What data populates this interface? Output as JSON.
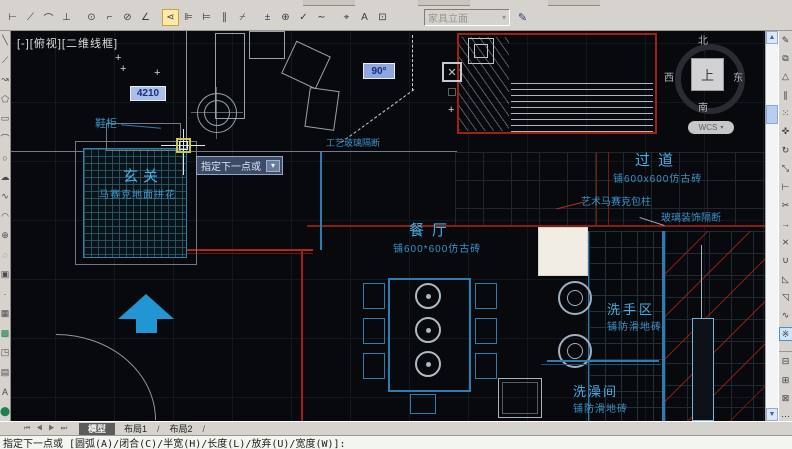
{
  "top_toolbar": {
    "dim_style": {
      "value": "家具立面",
      "caret": "▾"
    },
    "dim_icons": [
      {
        "n": "dim-linear-icon",
        "g": "⊢"
      },
      {
        "n": "dim-aligned-icon",
        "g": "⟋"
      },
      {
        "n": "dim-arc-length-icon",
        "g": "⌒"
      },
      {
        "n": "dim-ordinate-icon",
        "g": "⊥"
      },
      {
        "n": "dim-radius-icon",
        "g": "⊙",
        "sep": true
      },
      {
        "n": "dim-jogged-icon",
        "g": "⌐"
      },
      {
        "n": "dim-diameter-icon",
        "g": "⊘"
      },
      {
        "n": "dim-angular-icon",
        "g": "∠"
      },
      {
        "n": "dim-quick-icon",
        "g": "⋖",
        "hl": true,
        "sep": true
      },
      {
        "n": "dim-baseline-icon",
        "g": "⊫"
      },
      {
        "n": "dim-continue-icon",
        "g": "⊨"
      },
      {
        "n": "dim-space-icon",
        "g": "∥"
      },
      {
        "n": "dim-break-icon",
        "g": "⌿"
      },
      {
        "n": "dim-tolerance-icon",
        "g": "±",
        "sep": true
      },
      {
        "n": "dim-center-mark-icon",
        "g": "⊕"
      },
      {
        "n": "dim-inspect-icon",
        "g": "✓"
      },
      {
        "n": "dim-jogged-linear-icon",
        "g": "∼"
      },
      {
        "n": "dim-edit-icon",
        "g": "⌖",
        "sep": true
      },
      {
        "n": "dim-text-edit-icon",
        "g": "A"
      },
      {
        "n": "dim-update-icon",
        "g": "⊡"
      }
    ],
    "style_manager_icon": "✎"
  },
  "left_toolbar": {
    "icons": [
      {
        "n": "draw-line-icon",
        "g": "╲"
      },
      {
        "n": "draw-xline-icon",
        "g": "⟋"
      },
      {
        "n": "draw-polyline-icon",
        "g": "↝"
      },
      {
        "n": "draw-polygon-icon",
        "g": "⬠"
      },
      {
        "n": "draw-rectangle-icon",
        "g": "▭"
      },
      {
        "n": "draw-arc-icon",
        "g": "⌒"
      },
      {
        "n": "draw-circle-icon",
        "g": "○"
      },
      {
        "n": "draw-revcloud-icon",
        "g": "☁"
      },
      {
        "n": "draw-spline-icon",
        "g": "∿"
      },
      {
        "n": "draw-ellipse-icon",
        "g": "◠"
      },
      {
        "n": "draw-ellipse-arc-icon",
        "g": "⊕"
      },
      {
        "n": "draw-insert-block-icon",
        "g": "◌"
      },
      {
        "n": "draw-make-block-icon",
        "g": "▣"
      },
      {
        "n": "draw-point-icon",
        "g": "·"
      },
      {
        "n": "draw-hatch-icon",
        "g": "▦"
      },
      {
        "n": "draw-gradient-icon",
        "g": "▩",
        "hl": true
      },
      {
        "n": "draw-region-icon",
        "g": "◳"
      },
      {
        "n": "draw-table-icon",
        "g": "▤"
      },
      {
        "n": "draw-mtext-icon",
        "g": "A"
      },
      {
        "n": "draw-scale-ref-icon",
        "g": "⬤",
        "hl": true
      }
    ]
  },
  "right_toolbar": {
    "icons": [
      {
        "n": "modify-erase-icon",
        "g": "✎"
      },
      {
        "n": "modify-copy-icon",
        "g": "⧉"
      },
      {
        "n": "modify-mirror-icon",
        "g": "△"
      },
      {
        "n": "modify-offset-icon",
        "g": "∥"
      },
      {
        "n": "modify-array-icon",
        "g": "⁙"
      },
      {
        "n": "modify-move-icon",
        "g": "✜"
      },
      {
        "n": "modify-rotate-icon",
        "g": "↻"
      },
      {
        "n": "modify-scale-icon",
        "g": "⤡"
      },
      {
        "n": "modify-stretch-icon",
        "g": "⊢"
      },
      {
        "n": "modify-trim-icon",
        "g": "✂"
      },
      {
        "n": "modify-extend-icon",
        "g": "→"
      },
      {
        "n": "modify-break-point-icon",
        "g": "⨯"
      },
      {
        "n": "modify-join-icon",
        "g": "∪"
      },
      {
        "n": "modify-chamfer-icon",
        "g": "◺"
      },
      {
        "n": "modify-fillet-icon",
        "g": "◹"
      },
      {
        "n": "modify-spline-edit-icon",
        "g": "∿"
      },
      {
        "n": "modify-explode-icon",
        "g": "※",
        "hl": true
      },
      {
        "n": "draworder-front-icon",
        "g": "⊟",
        "sep": true
      },
      {
        "n": "draworder-back-icon",
        "g": "⊞"
      },
      {
        "n": "draworder-above-icon",
        "g": "⊠"
      },
      {
        "n": "draworder-more-icon",
        "g": "⋯"
      }
    ]
  },
  "scrollbar": {
    "up": "▲",
    "down": "▼"
  },
  "viewport": {
    "label": "[-][俯视][二维线框]"
  },
  "viewcube": {
    "north": "北",
    "south": "南",
    "east": "东",
    "west": "西",
    "top": "上",
    "wcs": "WCS",
    "caret": "▾"
  },
  "plan": {
    "rooms": [
      {
        "name": "玄关",
        "sub": "马赛克地面拼花"
      },
      {
        "name": "过道",
        "sub": "铺600x600仿古砖"
      },
      {
        "name": "餐厅",
        "sub": "铺600*600仿古砖"
      },
      {
        "name": "洗手区",
        "sub": "铺防滑地砖"
      },
      {
        "name": "洗澡间",
        "sub": "铺防滑地砖"
      }
    ],
    "annotations": [
      {
        "text": "鞋柜"
      },
      {
        "text": "工艺玻璃隔断"
      },
      {
        "text": "艺术马赛克包柱"
      },
      {
        "text": "玻璃装饰隔断"
      }
    ],
    "blip": "+",
    "xmark": "✕"
  },
  "dynamic_input": {
    "length": "4210",
    "angle": "90°",
    "tooltip": "指定下一点或",
    "tooltip_key": "▾"
  },
  "tabs": {
    "nav": "⏮ ◀ ▶ ⏭",
    "model": "模型",
    "layout1": "布局1",
    "layout2": "布局2",
    "slash": "/"
  },
  "command_line": {
    "prompt": "指定下一点或 [圆弧(A)/闭合(C)/半宽(H)/长度(L)/放弃(U)/宽度(W)]:"
  },
  "colors": {
    "accent_cyan": "#45b0e6",
    "wall_red": "#b22418",
    "geometry_blue": "#2d7cb2",
    "arrow_blue": "#2196d2"
  }
}
